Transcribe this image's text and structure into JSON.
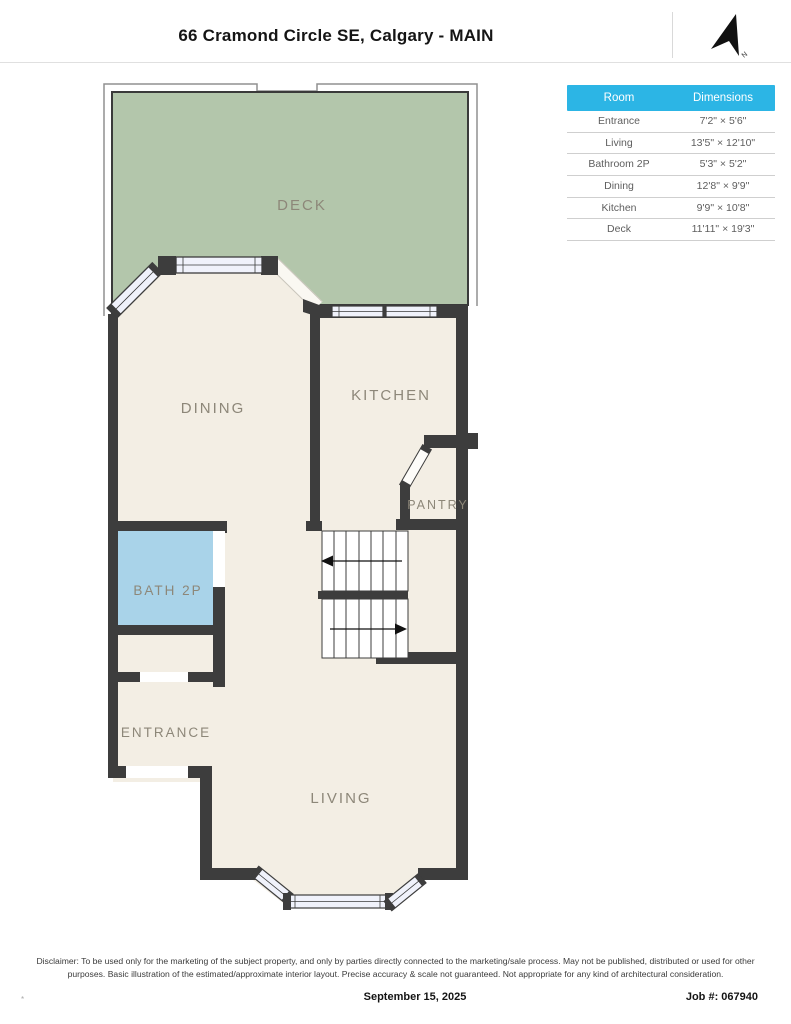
{
  "header": {
    "title": "66 Cramond Circle SE, Calgary - MAIN"
  },
  "compass": {
    "label": "N"
  },
  "table": {
    "columns": [
      "Room",
      "Dimensions"
    ],
    "header_bg": "#2CB5E5",
    "header_text_color": "#FFFFFF",
    "rows": [
      {
        "room": "Entrance",
        "dimensions": "7'2\" × 5'6\""
      },
      {
        "room": "Living",
        "dimensions": "13'5\" × 12'10\""
      },
      {
        "room": "Bathroom 2P",
        "dimensions": "5'3\" × 5'2\""
      },
      {
        "room": "Dining",
        "dimensions": "12'8\" × 9'9\""
      },
      {
        "room": "Kitchen",
        "dimensions": "9'9\" × 10'8\""
      },
      {
        "room": "Deck",
        "dimensions": "11'11\" × 19'3\""
      }
    ]
  },
  "plan": {
    "labels": {
      "deck": "DECK",
      "dining": "DINING",
      "kitchen": "KITCHEN",
      "pantry": "PANTRY",
      "bath": "BATH 2P",
      "entrance": "ENTRANCE",
      "living": "LIVING"
    },
    "colors": {
      "wall": "#3D3D3D",
      "floor": "#F3EEE4",
      "deck": "#B3C6AB",
      "bath": "#A9D3E9",
      "window": "#F0F2FB",
      "label": "#8D8779",
      "deck_label": "#7E9077"
    }
  },
  "footer": {
    "disclaimer": "Disclaimer: To be used only for the marketing of the subject property, and only by parties directly connected to the marketing/sale process. May not be published, distributed or used for other purposes. Basic illustration of the estimated/approximate interior layout. Precise accuracy & scale not guaranteed. Not appropriate for any kind of architectural consideration.",
    "corner_mark": "*",
    "date": "September 15, 2025",
    "job": "Job #: 067940"
  }
}
